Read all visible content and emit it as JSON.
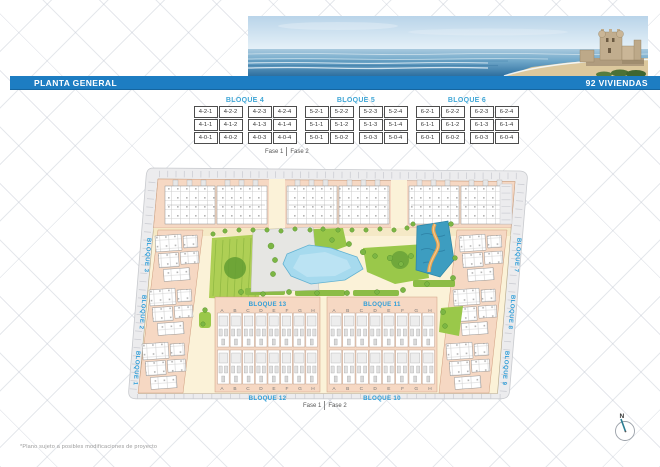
{
  "header": {
    "title": "PLANTA GENERAL",
    "units_label": "92 VIVIENDAS"
  },
  "tables": [
    {
      "title": "BLOQUE 4",
      "rows": [
        [
          "4-2-1",
          "4-2-2",
          "4-2-3",
          "4-2-4"
        ],
        [
          "4-1-1",
          "4-1-2",
          "4-1-3",
          "4-1-4"
        ],
        [
          "4-0-1",
          "4-0-2",
          "4-0-3",
          "4-0-4"
        ]
      ]
    },
    {
      "title": "BLOQUE 5",
      "rows": [
        [
          "5-2-1",
          "5-2-2",
          "5-2-3",
          "5-2-4"
        ],
        [
          "5-1-1",
          "5-1-2",
          "5-1-3",
          "5-1-4"
        ],
        [
          "5-0-1",
          "5-0-2",
          "5-0-3",
          "5-0-4"
        ]
      ]
    },
    {
      "title": "BLOQUE 6",
      "rows": [
        [
          "6-2-1",
          "6-2-2",
          "6-2-3",
          "6-2-4"
        ],
        [
          "6-1-1",
          "6-1-2",
          "6-1-3",
          "6-1-4"
        ],
        [
          "6-0-1",
          "6-0-2",
          "6-0-3",
          "6-0-4"
        ]
      ]
    }
  ],
  "phases": {
    "fase1": "Fase 1",
    "fase2": "Fase 2"
  },
  "plan": {
    "side_labels_left": [
      "BLOQUE 3",
      "BLOQUE 2",
      "BLOQUE 1"
    ],
    "side_labels_right": [
      "BLOQUE 7",
      "BLOQUE 8",
      "BLOQUE 9"
    ],
    "sections": [
      {
        "top": "BLOQUE 13",
        "bottom": "BLOQUE 12"
      },
      {
        "top": "BLOQUE 11",
        "bottom": "BLOQUE 10"
      }
    ],
    "unit_letters": [
      "A",
      "B",
      "C",
      "D",
      "E",
      "F",
      "G",
      "H"
    ]
  },
  "compass": {
    "label": "N"
  },
  "footer": {
    "note": "*Plano sujeto a posibles modificaciones de proyecto"
  },
  "colors": {
    "bar_blue": "#1d7dc2",
    "label_blue": "#35a3d8",
    "salmon": "#f6d8c3",
    "cream": "#fbf2d8",
    "pool_blue": "#a6daee",
    "river_teal": "#3d9dc0",
    "river_path_orange": "#e8a352",
    "green": "#9cc84a",
    "road_gray": "#ececee"
  }
}
